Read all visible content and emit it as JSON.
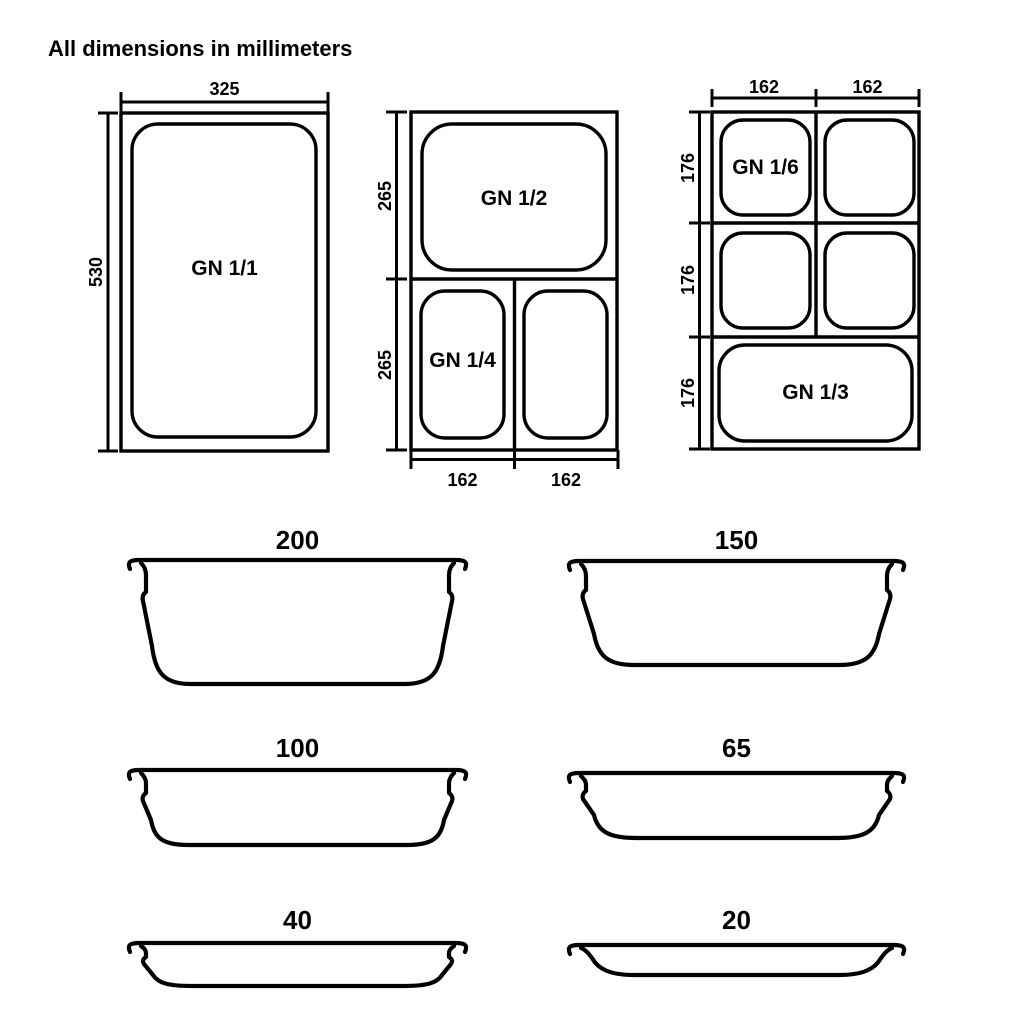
{
  "title": "All dimensions in millimeters",
  "colors": {
    "line": "#000000",
    "background": "#ffffff"
  },
  "gn11": {
    "label": "GN 1/1",
    "width_dim": "325",
    "height_dim": "530"
  },
  "gn_half": {
    "half_label": "GN 1/2",
    "quarter_label": "GN 1/4",
    "dim_top_half": "265",
    "dim_bottom_half": "265",
    "dim_bottom_left": "162",
    "dim_bottom_right": "162"
  },
  "gn_third": {
    "sixth_label": "GN 1/6",
    "third_label": "GN 1/3",
    "dim_col_left": "162",
    "dim_col_right": "162",
    "dim_row_1": "176",
    "dim_row_2": "176",
    "dim_row_3": "176"
  },
  "depths": {
    "d200": "200",
    "d150": "150",
    "d100": "100",
    "d65": "65",
    "d40": "40",
    "d20": "20"
  }
}
